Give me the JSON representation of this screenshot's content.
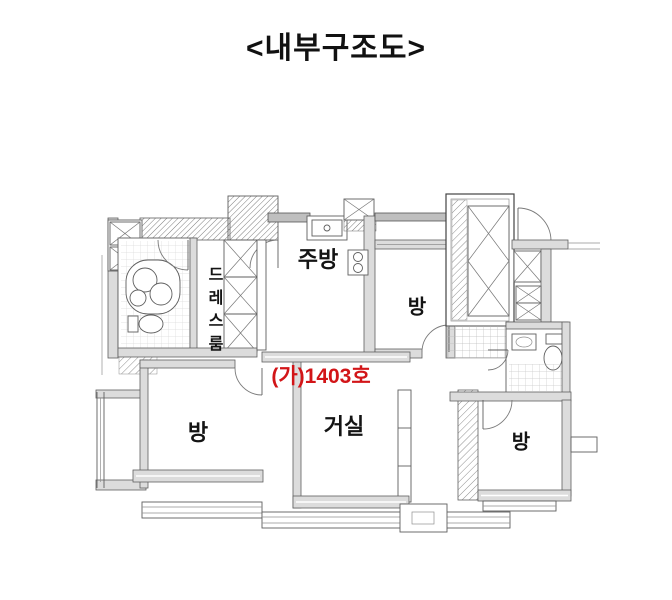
{
  "title": "<내부구조도>",
  "unit_label": {
    "text": "(가)1403호",
    "color": "#d21518"
  },
  "rooms": {
    "kitchen": {
      "label": "주방"
    },
    "room_top": {
      "label": "방"
    },
    "dress_room": {
      "label": "드레스룸"
    },
    "room_left": {
      "label": "방"
    },
    "living_room": {
      "label": "거실"
    },
    "room_right": {
      "label": "방"
    }
  },
  "small_labels": {
    "duct": "AD"
  },
  "colors": {
    "ink": "#141414",
    "unit_red": "#d21518",
    "wall_fill": "#dcdcdc",
    "line": "#5f5f5f",
    "background": "#ffffff"
  }
}
